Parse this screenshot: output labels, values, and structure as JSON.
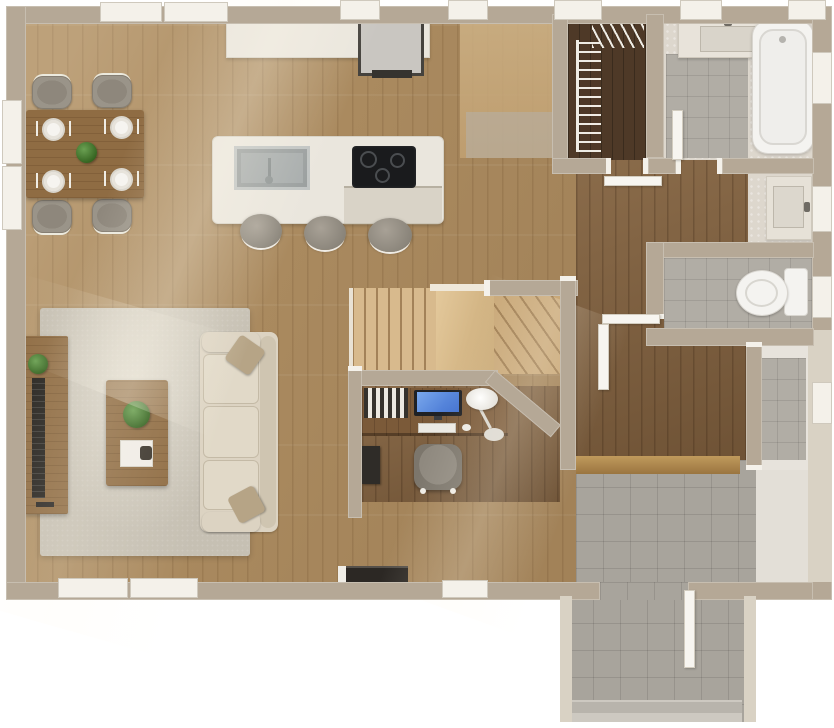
{
  "palette": {
    "bg": "#ffffff",
    "wall": "#b5a896",
    "wall_light": "#d9d2c4",
    "cut_white": "#f4f1ea",
    "wood": "#ab8b60",
    "wood_dark": "#7d5d3c",
    "wood_closet": "#4e3927",
    "wood_table": "#8f6c43",
    "stair": "#d8ba8d",
    "stair_shade": "#c9a878",
    "counter": "#eae6dd",
    "rug": "#c6c0b3",
    "sofa": "#dcd3c2",
    "pillow": "#b6a486",
    "chair": "#9a9489",
    "tile": "#b1ada5",
    "tile_entry": "#a8a49c",
    "marble": "#ddd7cd",
    "white_fix": "#f4f3f0",
    "cooktop": "#1a1b1d",
    "steel": "#a7acac",
    "screen": "#3f6fd0",
    "tv": "#26231f",
    "plant": "#33621f"
  },
  "plan": {
    "view": "top-down 3D rendered floor plan, single storey",
    "rooms": [
      {
        "name": "dining-area",
        "floor": "hardwood",
        "items": [
          "dining-table",
          "dining-chair x4",
          "place-setting x4",
          "centerpiece-plant"
        ]
      },
      {
        "name": "kitchen",
        "floor": "hardwood",
        "items": [
          "wall-counter",
          "refrigerator",
          "kitchen-island",
          "double-sink",
          "cooktop-3-burner",
          "bar-stool x3"
        ]
      },
      {
        "name": "living-room",
        "floor": "hardwood + area-rug",
        "items": [
          "sofa-3-seat",
          "throw-pillow x2",
          "coffee-table",
          "potted-plant x2",
          "tv-console",
          "tv"
        ]
      },
      {
        "name": "staircase",
        "floor": "light-wood treads",
        "items": [
          "straight-treads",
          "landing-ramp",
          "winder-treads"
        ]
      },
      {
        "name": "office-nook",
        "floor": "hardwood",
        "items": [
          "built-in-desk",
          "monitor",
          "keyboard",
          "mouse",
          "desk-lamp",
          "office-chair",
          "book-row",
          "pc-tower"
        ]
      },
      {
        "name": "walk-in-closet",
        "floor": "dark-hardwood",
        "items": [
          "wire-shelving-side",
          "wire-shelving-top"
        ]
      },
      {
        "name": "bathroom",
        "floor": "marble + shower-tile",
        "items": [
          "vanity-sink",
          "shower-fixture",
          "bathtub"
        ]
      },
      {
        "name": "hallway",
        "floor": "dark-hardwood",
        "items": []
      },
      {
        "name": "vanity-alcove",
        "floor": "marble",
        "items": [
          "vanity-sink"
        ]
      },
      {
        "name": "water-closet",
        "floor": "tile",
        "items": [
          "toilet"
        ]
      },
      {
        "name": "storage-room",
        "floor": "tile",
        "items": []
      },
      {
        "name": "mudroom-entry",
        "floor": "tile",
        "items": [
          "wood-threshold",
          "hearth-bench"
        ]
      },
      {
        "name": "entry-porch",
        "floor": "tile",
        "items": [
          "front-door-open",
          "porch-step"
        ]
      }
    ],
    "openings": {
      "windows_top": 7,
      "windows_left": 2,
      "windows_bottom": 3,
      "windows_right": 4,
      "doors": [
        "closet-door",
        "bathroom-door",
        "water-closet-door",
        "hall-door",
        "front-door"
      ]
    }
  }
}
